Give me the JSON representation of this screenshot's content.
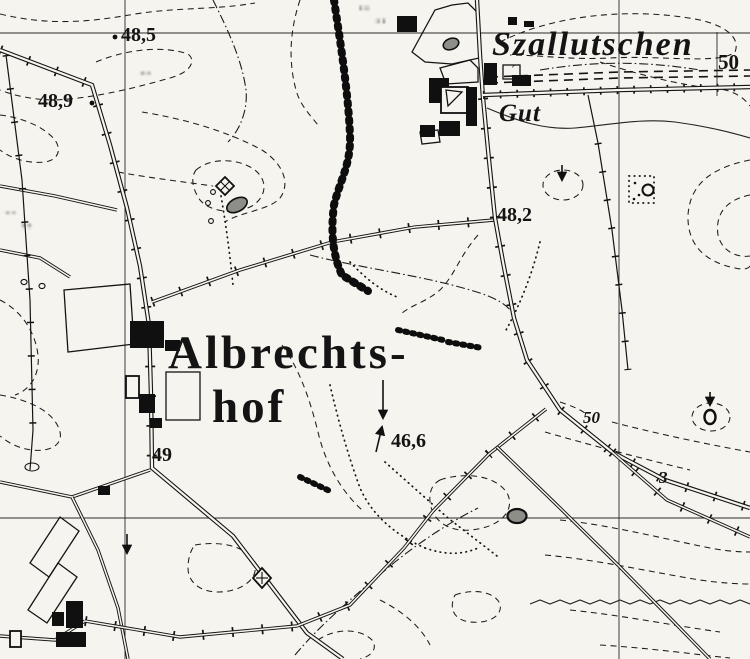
{
  "map": {
    "names": {
      "village": "Szallutschen",
      "estate": "Gut",
      "farm_line1": "Albrechts-",
      "farm_line2": "hof"
    },
    "grid_label": {
      "text": "50"
    },
    "spot_heights": [
      {
        "name": "spot-height-48-5",
        "text": "48,5",
        "x": 121,
        "y": 24
      },
      {
        "name": "spot-height-48-9",
        "text": "48,9",
        "x": 38,
        "y": 90
      },
      {
        "name": "spot-height-48-2",
        "text": "48,2",
        "x": 497,
        "y": 204
      },
      {
        "name": "spot-height-46-6",
        "text": "46,6",
        "x": 391,
        "y": 430
      },
      {
        "name": "spot-height-49",
        "text": "49",
        "x": 152,
        "y": 444
      }
    ],
    "contour_labels": [
      {
        "name": "contour-label-50",
        "text": "50",
        "x": 583,
        "y": 408
      },
      {
        "name": "parcel-label-3",
        "text": "3",
        "x": 659,
        "y": 468
      }
    ]
  },
  "colors": {
    "paper": "#f6f4ee",
    "ink": "#141414",
    "pond_fill": "#8e8e88"
  }
}
